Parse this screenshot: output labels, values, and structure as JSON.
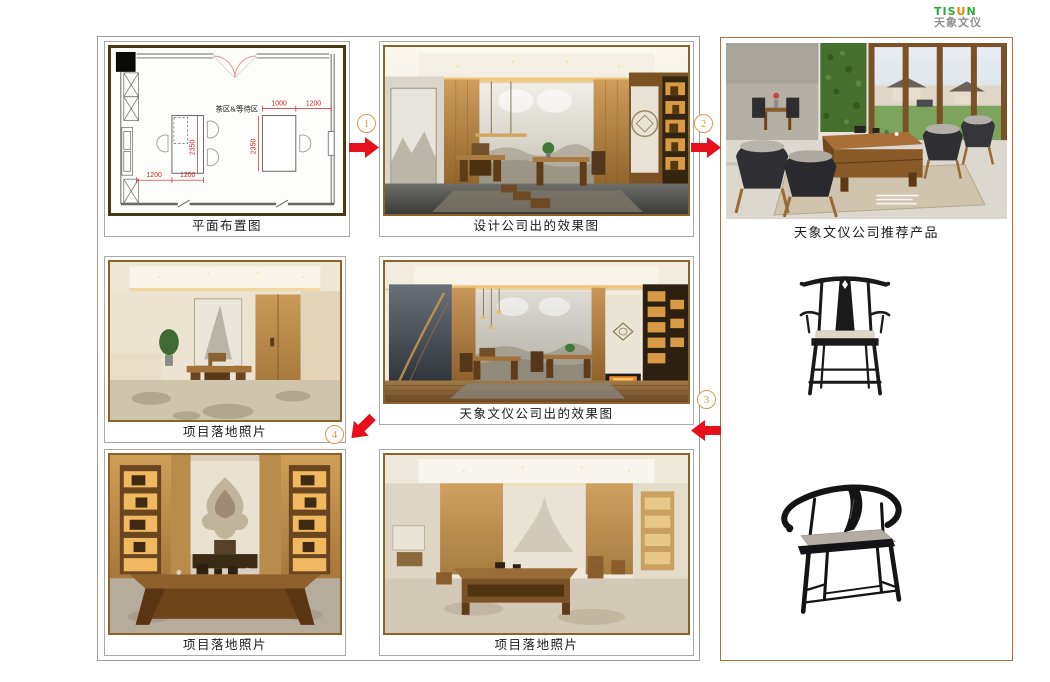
{
  "logo": {
    "part_green_1": "TIS",
    "part_orange": "U",
    "part_green_2": "N",
    "chinese": "天象文仪"
  },
  "captions": {
    "floor_plan": "平面布置图",
    "design_render": "设计公司出的效果图",
    "recommended_products": "天象文仪公司推荐产品",
    "tisun_render": "天象文仪公司出的效果图",
    "project_photo_left": "项目落地照片",
    "project_photo_bottom_left": "项目落地照片",
    "project_photo_bottom_mid": "项目落地照片"
  },
  "steps": {
    "one": "1",
    "two": "2",
    "three": "3",
    "four": "4"
  },
  "floor_plan": {
    "area_label": "茶区&等待区",
    "dim_top_1": "1000",
    "dim_top_2": "1200",
    "dim_table_left": "2350",
    "dim_table_right": "2350",
    "dim_bottom_1": "1200",
    "dim_bottom_2": "1200"
  },
  "colors": {
    "arrow_red": "#e8101c",
    "step_orange": "#e2944e",
    "right_panel_border": "#ad713d",
    "photo_frame_brown": "#8a6328",
    "plan_frame_olive": "#473a10",
    "logo_green": "#2faa3c",
    "logo_orange": "#f08300"
  }
}
